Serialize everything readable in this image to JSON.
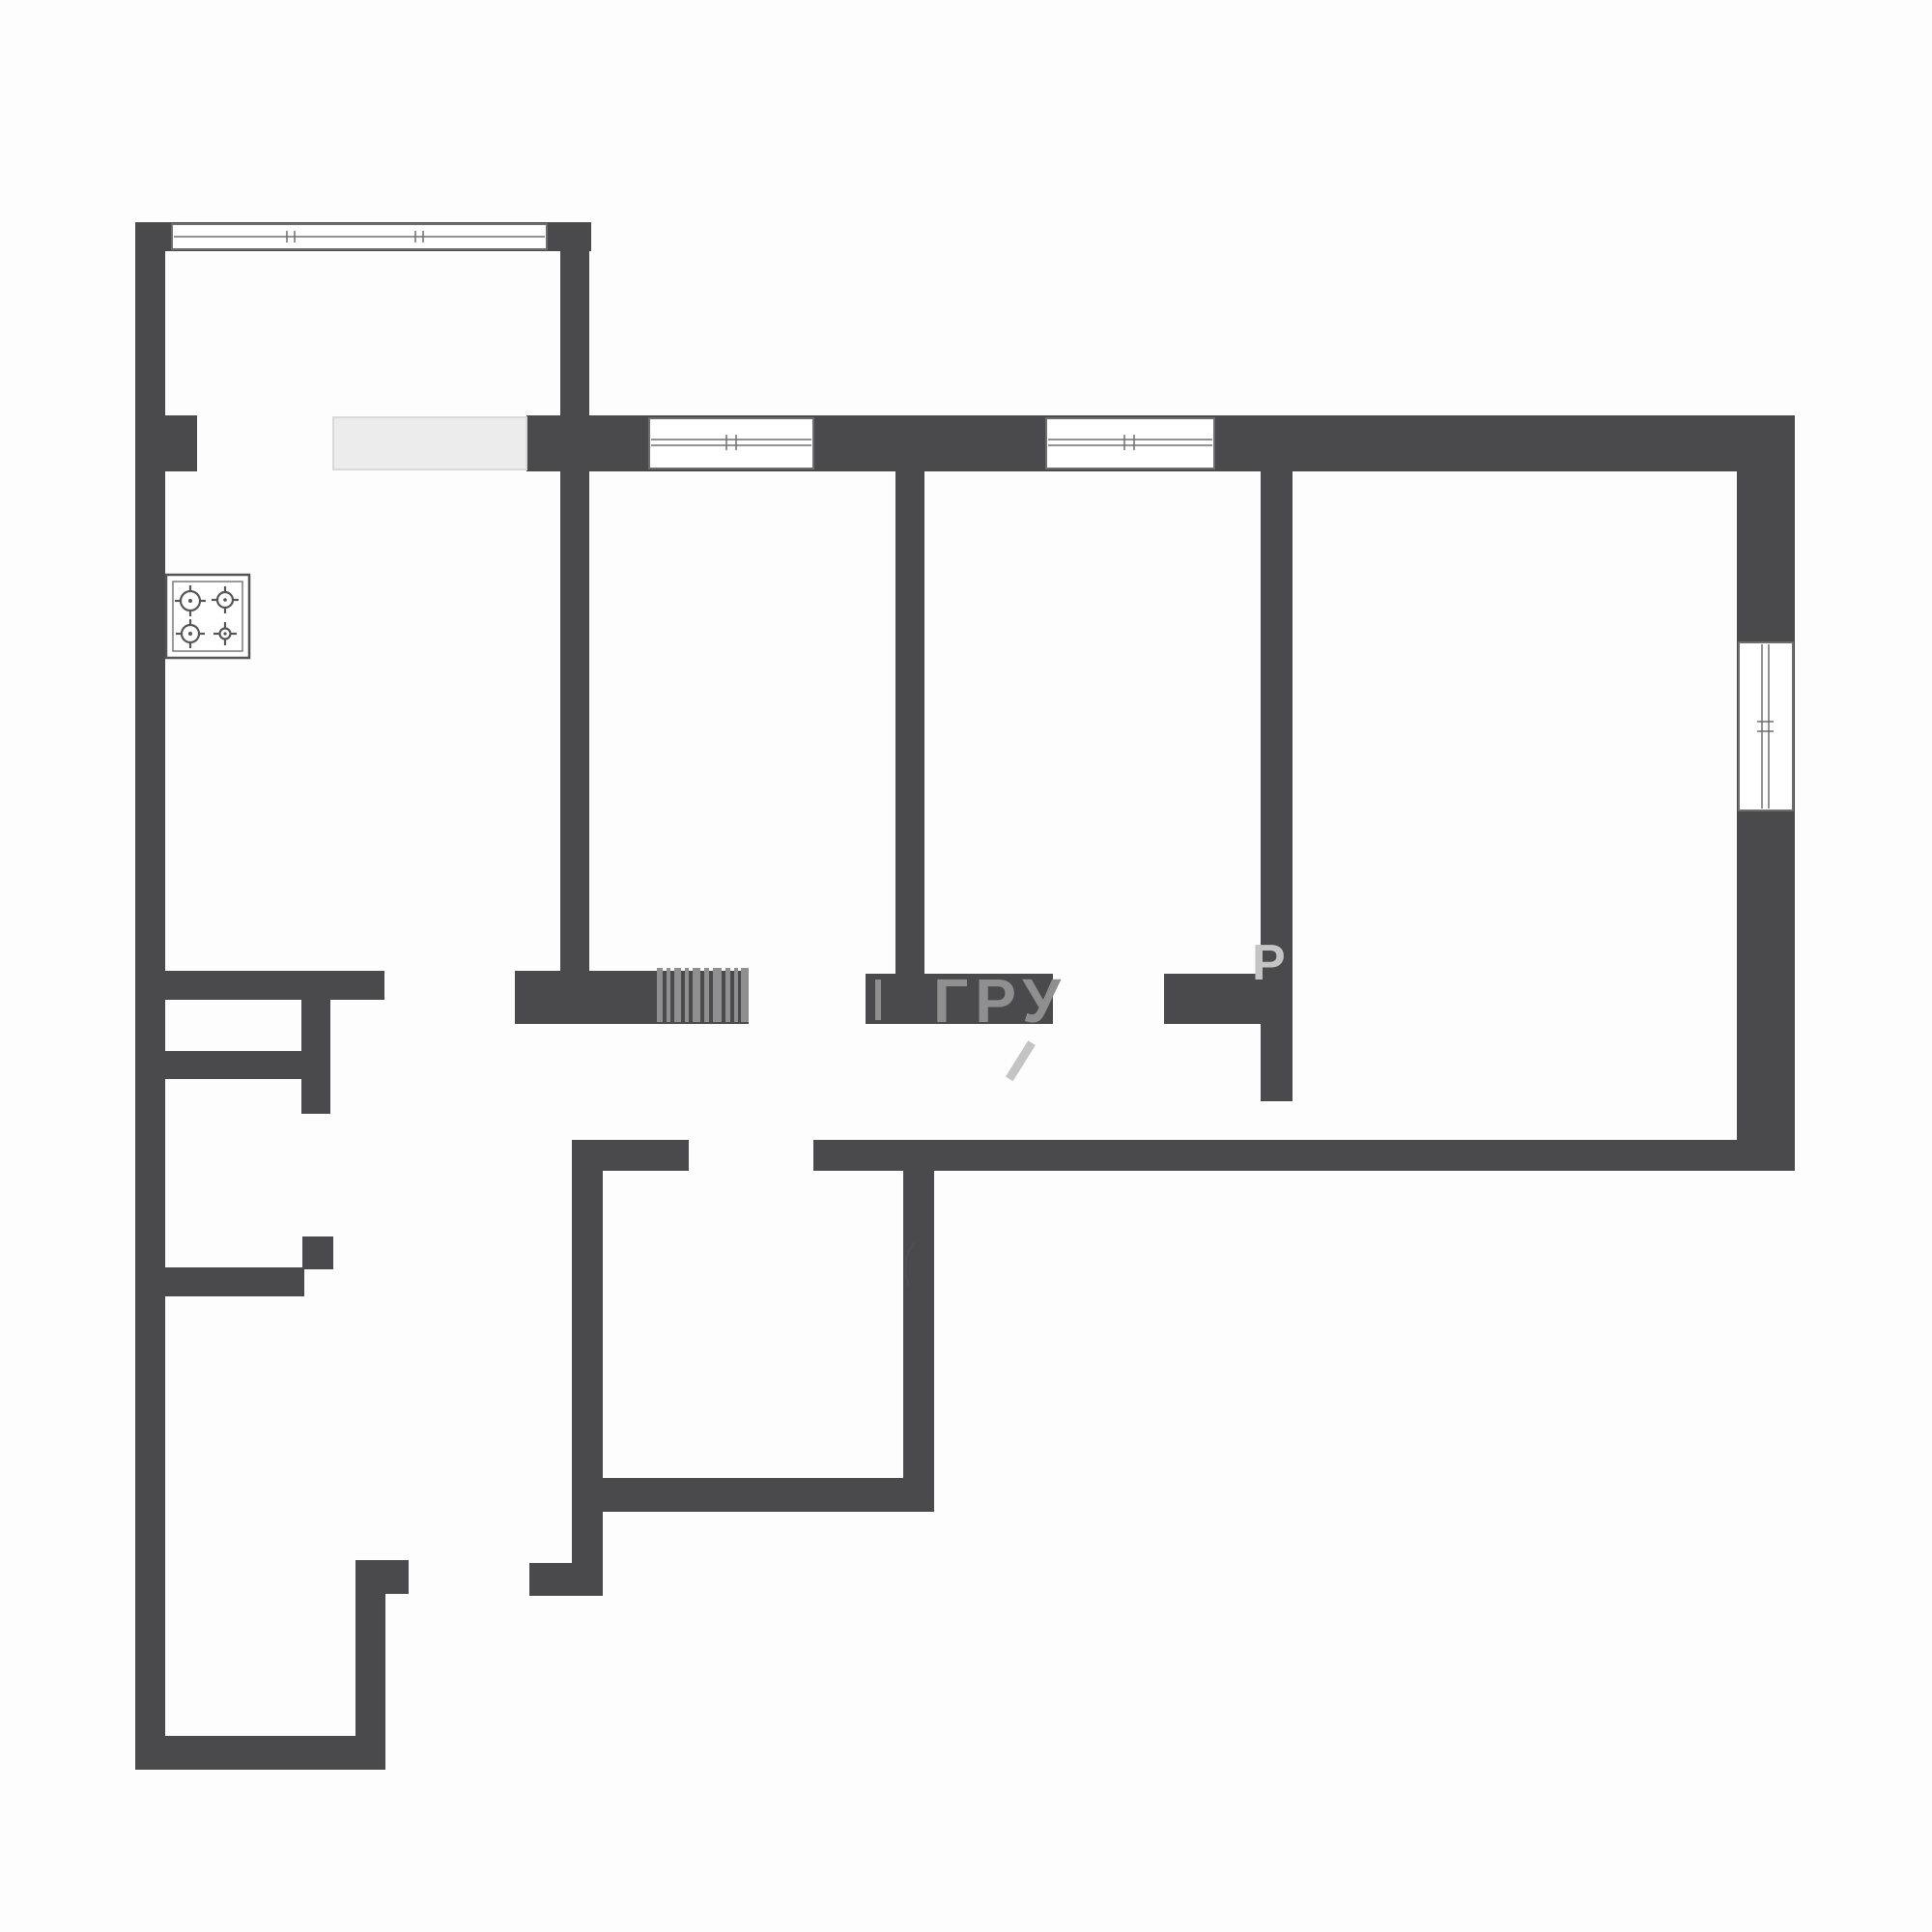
{
  "meta": {
    "kind": "apartment-floor-plan",
    "background": "#fdfdfd"
  },
  "colors": {
    "wall": "#4a4a4c",
    "counter_fill": "#ececec",
    "counter_border": "#d9d9d9",
    "window_line": "#6e6e6e",
    "watermark": "#8f8f8f",
    "watermark_faint": "#c4c4c4",
    "stove_line": "#555555",
    "bg": "#fdfdfd"
  },
  "watermark": {
    "text_main": "ГРУ",
    "text_fragment": "Р",
    "bars_count": 10
  },
  "fixtures": {
    "stove_burners": 4,
    "window_count": 4,
    "doorway_count": 6
  }
}
